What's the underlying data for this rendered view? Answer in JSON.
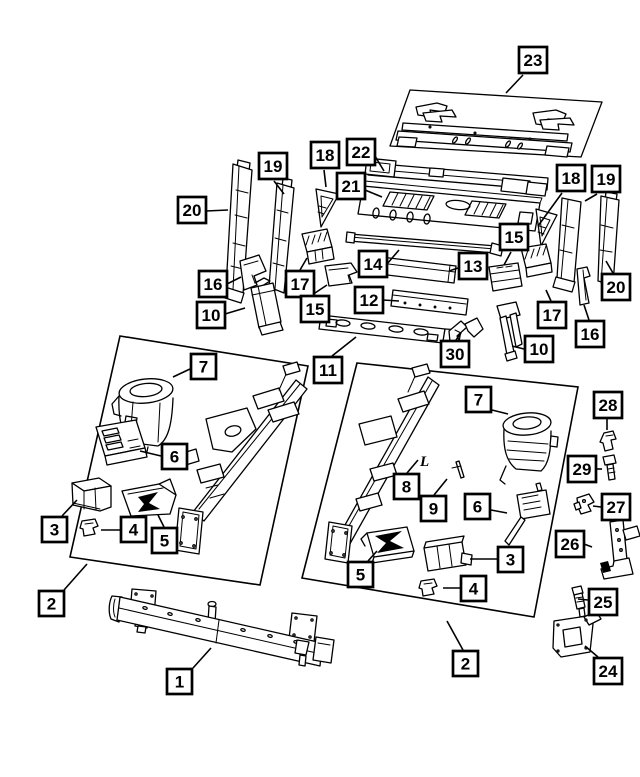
{
  "page": {
    "background": "#ffffff",
    "ink": "#000000",
    "callout_fill": "#ffffff",
    "callout_border": "#000000"
  },
  "diagram": {
    "callouts": [
      {
        "num": "23",
        "x": 519,
        "y": 47,
        "leader": [
          [
            523,
            75
          ],
          [
            506,
            93
          ]
        ]
      },
      {
        "num": "18",
        "x": 311,
        "y": 142,
        "leader": [
          [
            324,
            170
          ],
          [
            326,
            187
          ]
        ]
      },
      {
        "num": "19",
        "x": 259,
        "y": 153,
        "leader": [
          [
            274,
            181
          ],
          [
            284,
            194
          ]
        ]
      },
      {
        "num": "22",
        "x": 347,
        "y": 139,
        "leader": [
          [
            375,
            156
          ],
          [
            384,
            171
          ]
        ]
      },
      {
        "num": "21",
        "x": 337,
        "y": 173,
        "leader": [
          [
            365,
            190
          ],
          [
            382,
            197
          ]
        ]
      },
      {
        "num": "20",
        "x": 178,
        "y": 197,
        "leader": [
          [
            206,
            211
          ],
          [
            228,
            210
          ]
        ]
      },
      {
        "num": "18",
        "x": 557,
        "y": 165,
        "leader": [
          [
            562,
            193
          ],
          [
            538,
            226
          ]
        ]
      },
      {
        "num": "19",
        "x": 592,
        "y": 166,
        "leader": [
          [
            597,
            194
          ],
          [
            585,
            201
          ]
        ]
      },
      {
        "num": "15",
        "x": 500,
        "y": 224,
        "leader": [
          [
            511,
            252
          ],
          [
            504,
            265
          ]
        ]
      },
      {
        "num": "14",
        "x": 359,
        "y": 251,
        "leader": [
          [
            387,
            264
          ],
          [
            399,
            250
          ]
        ]
      },
      {
        "num": "13",
        "x": 459,
        "y": 253,
        "leader": [
          [
            458,
            268
          ],
          [
            449,
            271
          ]
        ]
      },
      {
        "num": "16",
        "x": 199,
        "y": 271,
        "leader": [
          [
            227,
            284
          ],
          [
            241,
            277
          ]
        ]
      },
      {
        "num": "17",
        "x": 286,
        "y": 271,
        "leader": [
          [
            300,
            270
          ],
          [
            307,
            258
          ]
        ]
      },
      {
        "num": "20",
        "x": 602,
        "y": 274,
        "leader": [
          [
            613,
            273
          ],
          [
            606,
            261
          ]
        ]
      },
      {
        "num": "12",
        "x": 355,
        "y": 287,
        "leader": [
          [
            383,
            300
          ],
          [
            399,
            301
          ]
        ]
      },
      {
        "num": "15",
        "x": 301,
        "y": 296,
        "leader": [
          [
            312,
            295
          ],
          [
            327,
            285
          ]
        ]
      },
      {
        "num": "10",
        "x": 197,
        "y": 302,
        "leader": [
          [
            225,
            314
          ],
          [
            245,
            308
          ]
        ]
      },
      {
        "num": "17",
        "x": 538,
        "y": 302,
        "leader": [
          [
            551,
            301
          ],
          [
            546,
            290
          ]
        ]
      },
      {
        "num": "16",
        "x": 576,
        "y": 321,
        "leader": [
          [
            589,
            320
          ],
          [
            584,
            305
          ]
        ]
      },
      {
        "num": "10",
        "x": 525,
        "y": 336,
        "leader": [
          [
            524,
            349
          ],
          [
            512,
            346
          ]
        ]
      },
      {
        "num": "30",
        "x": 441,
        "y": 341,
        "leader": [
          [
            456,
            340
          ],
          [
            461,
            333
          ]
        ]
      },
      {
        "num": "11",
        "x": 314,
        "y": 357,
        "leader": [
          [
            332,
            356
          ],
          [
            356,
            337
          ]
        ]
      },
      {
        "num": "7",
        "x": 191,
        "y": 354,
        "leader": [
          [
            190,
            369
          ],
          [
            173,
            377
          ]
        ]
      },
      {
        "num": "6",
        "x": 162,
        "y": 444,
        "leader": [
          [
            161,
            456
          ],
          [
            140,
            451
          ]
        ]
      },
      {
        "num": "3",
        "x": 42,
        "y": 517,
        "leader": [
          [
            62,
            516
          ],
          [
            77,
            500
          ]
        ]
      },
      {
        "num": "4",
        "x": 121,
        "y": 517,
        "leader": [
          [
            120,
            530
          ],
          [
            101,
            530
          ]
        ]
      },
      {
        "num": "5",
        "x": 152,
        "y": 528,
        "leader": [
          [
            164,
            527
          ],
          [
            158,
            515
          ]
        ]
      },
      {
        "num": "2",
        "x": 39,
        "y": 591,
        "leader": [
          [
            64,
            590
          ],
          [
            87,
            564
          ]
        ]
      },
      {
        "num": "1",
        "x": 167,
        "y": 669,
        "leader": [
          [
            193,
            668
          ],
          [
            211,
            648
          ]
        ]
      },
      {
        "num": "7",
        "x": 466,
        "y": 387,
        "leader": [
          [
            492,
            410
          ],
          [
            508,
            414
          ]
        ]
      },
      {
        "num": "8",
        "x": 394,
        "y": 474,
        "leader": [
          [
            407,
            473
          ],
          [
            418,
            460
          ]
        ]
      },
      {
        "num": "9",
        "x": 421,
        "y": 496,
        "leader": [
          [
            434,
            495
          ],
          [
            447,
            479
          ]
        ]
      },
      {
        "num": "6",
        "x": 465,
        "y": 494,
        "leader": [
          [
            491,
            510
          ],
          [
            507,
            513
          ]
        ]
      },
      {
        "num": "3",
        "x": 498,
        "y": 547,
        "leader": [
          [
            497,
            559
          ],
          [
            470,
            559
          ]
        ]
      },
      {
        "num": "4",
        "x": 461,
        "y": 576,
        "leader": [
          [
            460,
            588
          ],
          [
            443,
            588
          ]
        ]
      },
      {
        "num": "5",
        "x": 348,
        "y": 562,
        "leader": [
          [
            368,
            561
          ],
          [
            377,
            551
          ]
        ]
      },
      {
        "num": "2",
        "x": 453,
        "y": 651,
        "leader": [
          [
            463,
            650
          ],
          [
            447,
            621
          ]
        ]
      },
      {
        "num": "28",
        "x": 594,
        "y": 392,
        "leader": [
          [
            607,
            419
          ],
          [
            607,
            430
          ]
        ]
      },
      {
        "num": "29",
        "x": 568,
        "y": 456,
        "leader": [
          [
            596,
            469
          ],
          [
            602,
            469
          ]
        ]
      },
      {
        "num": "27",
        "x": 602,
        "y": 494,
        "leader": [
          [
            601,
            507
          ],
          [
            593,
            506
          ]
        ]
      },
      {
        "num": "26",
        "x": 556,
        "y": 531,
        "leader": [
          [
            584,
            544
          ],
          [
            592,
            547
          ]
        ]
      },
      {
        "num": "25",
        "x": 589,
        "y": 589,
        "leader": [
          [
            588,
            600
          ],
          [
            578,
            599
          ]
        ]
      },
      {
        "num": "24",
        "x": 594,
        "y": 658,
        "leader": [
          [
            598,
            657
          ],
          [
            585,
            646
          ]
        ]
      }
    ],
    "annotations": [
      {
        "text": "L",
        "x": 420,
        "y": 466,
        "size": 15
      }
    ]
  }
}
